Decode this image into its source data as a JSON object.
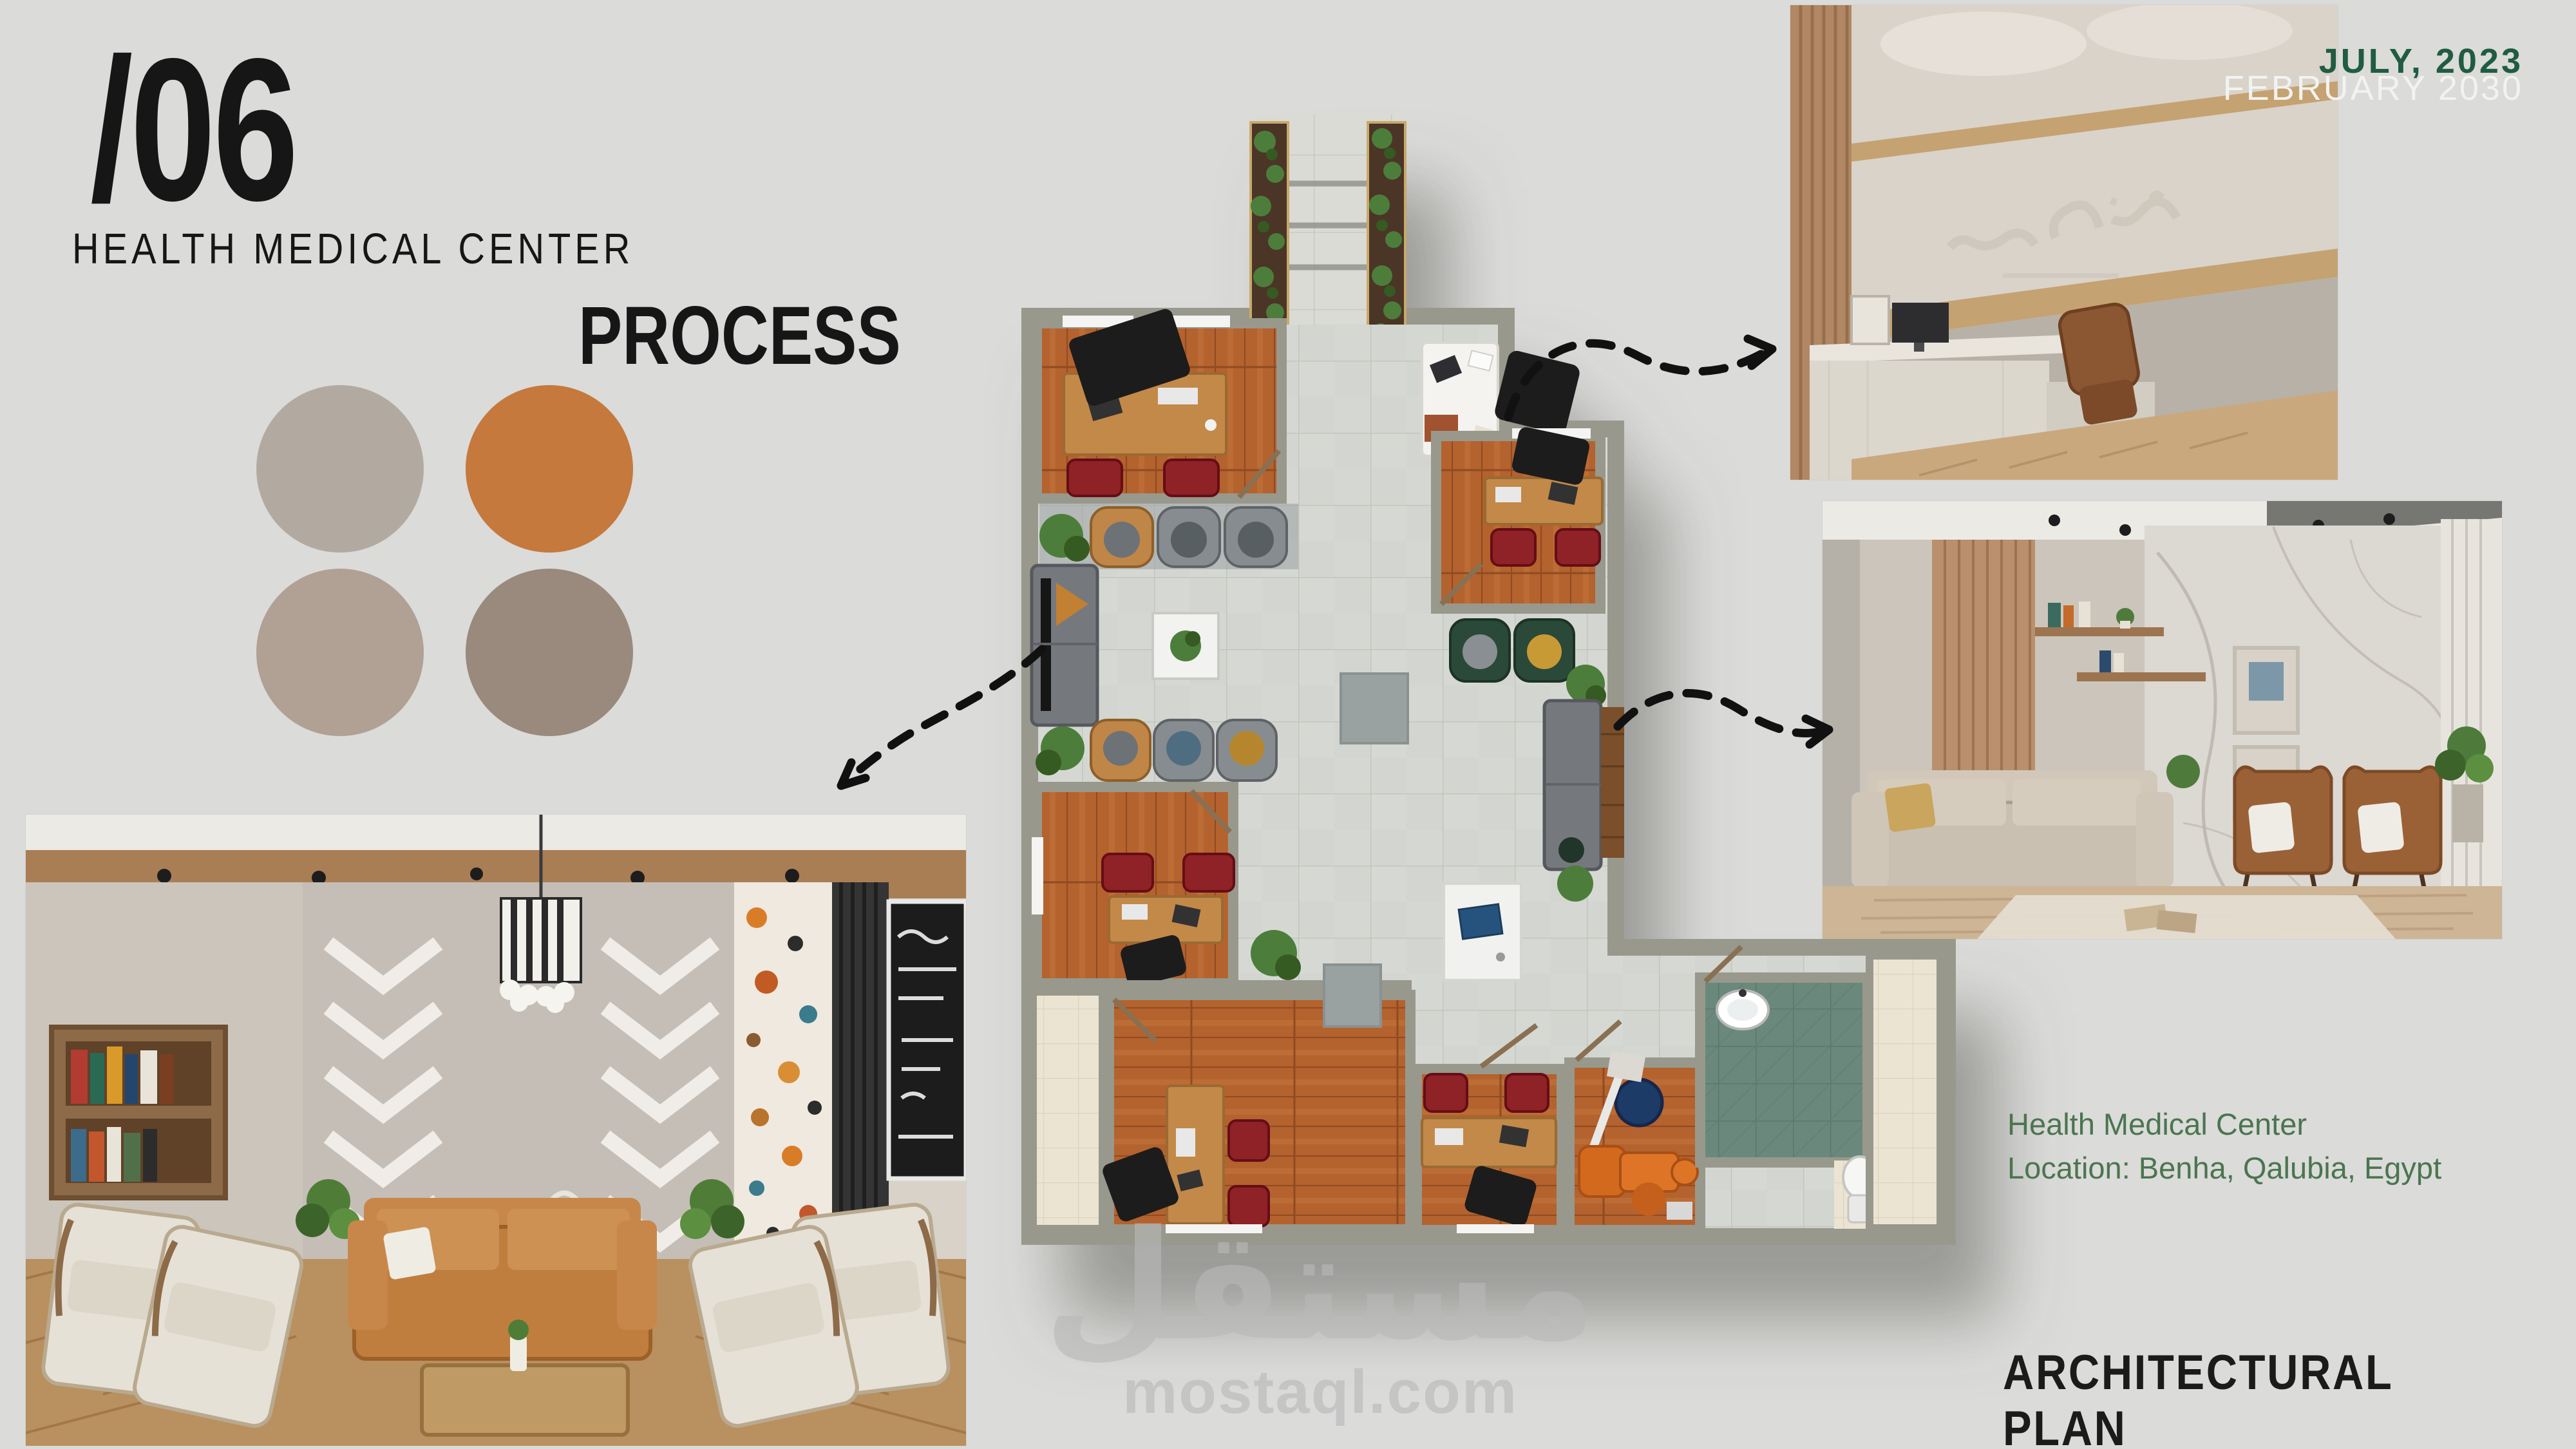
{
  "slide": {
    "background": "#dbdbd9",
    "section_number": "/06",
    "title": "HEALTH MEDICAL CENTER",
    "subtitle": "PROCESS",
    "dates": {
      "primary": "JULY,  2023",
      "secondary": "FEBRUARY 2030"
    },
    "info": {
      "line1": "Health Medical Center",
      "line2": "Location: Benha, Qalubia, Egypt"
    },
    "footer_label": "ARCHITECTURAL PLAN",
    "watermark": {
      "arabic": "مستقل",
      "domain": "mostaql.com"
    }
  },
  "palette": {
    "swatches": [
      {
        "name": "warm-gray",
        "hex": "#b2aaa1"
      },
      {
        "name": "terracotta",
        "hex": "#c5793c"
      },
      {
        "name": "taupe",
        "hex": "#b1a094"
      },
      {
        "name": "brown-gray",
        "hex": "#998a7d"
      }
    ]
  },
  "floor_plan": {
    "type": "architectural-top-view",
    "rooms": [
      "entrance-walkway",
      "office-top-left",
      "waiting-lobby",
      "office-mid-left",
      "office-top-right",
      "office-bottom-left",
      "office-bottom-mid",
      "dental-room",
      "bathroom",
      "balcony-left",
      "balcony-right"
    ],
    "callout_arrows": 3
  },
  "photos": [
    {
      "id": "lobby-interior",
      "position": "bottom-left"
    },
    {
      "id": "reception-interior",
      "position": "top-right"
    },
    {
      "id": "waiting-lounge-interior",
      "position": "middle-right"
    }
  ],
  "colors": {
    "bg": "#dbdbd9",
    "ink": "#161616",
    "green-dark": "#205c42",
    "green-info": "#4a7550",
    "white-date": "#f2f3f1",
    "watermark": "#b9b9b9",
    "swatch1": "#b2aaa1",
    "swatch2": "#c5793c",
    "swatch3": "#b1a094",
    "swatch4": "#998a7d",
    "wall": "#98988c",
    "tile": "#d3d6d0",
    "tile-line": "#c2c6be",
    "walk": "#d9dbd4",
    "walk-line": "#c8cbc3",
    "wood": "#b4622d",
    "wood-dark": "#8f4c22",
    "wood-light": "#c77a3f",
    "desk": "#c28949",
    "red-chair": "#8e2025",
    "bath": "#6b897b",
    "bath-line": "#5a796d",
    "cream": "#ece4d3",
    "cream-line": "#ddd3bd",
    "sofa": "#75797d",
    "green-chair": "#2c4a38",
    "tan-chair": "#c08647",
    "gray-chair": "#878c90",
    "plant": "#4e7d3a",
    "plant-dark": "#365a24",
    "black-obj": "#1d1d1d",
    "arrow": "#111111"
  }
}
